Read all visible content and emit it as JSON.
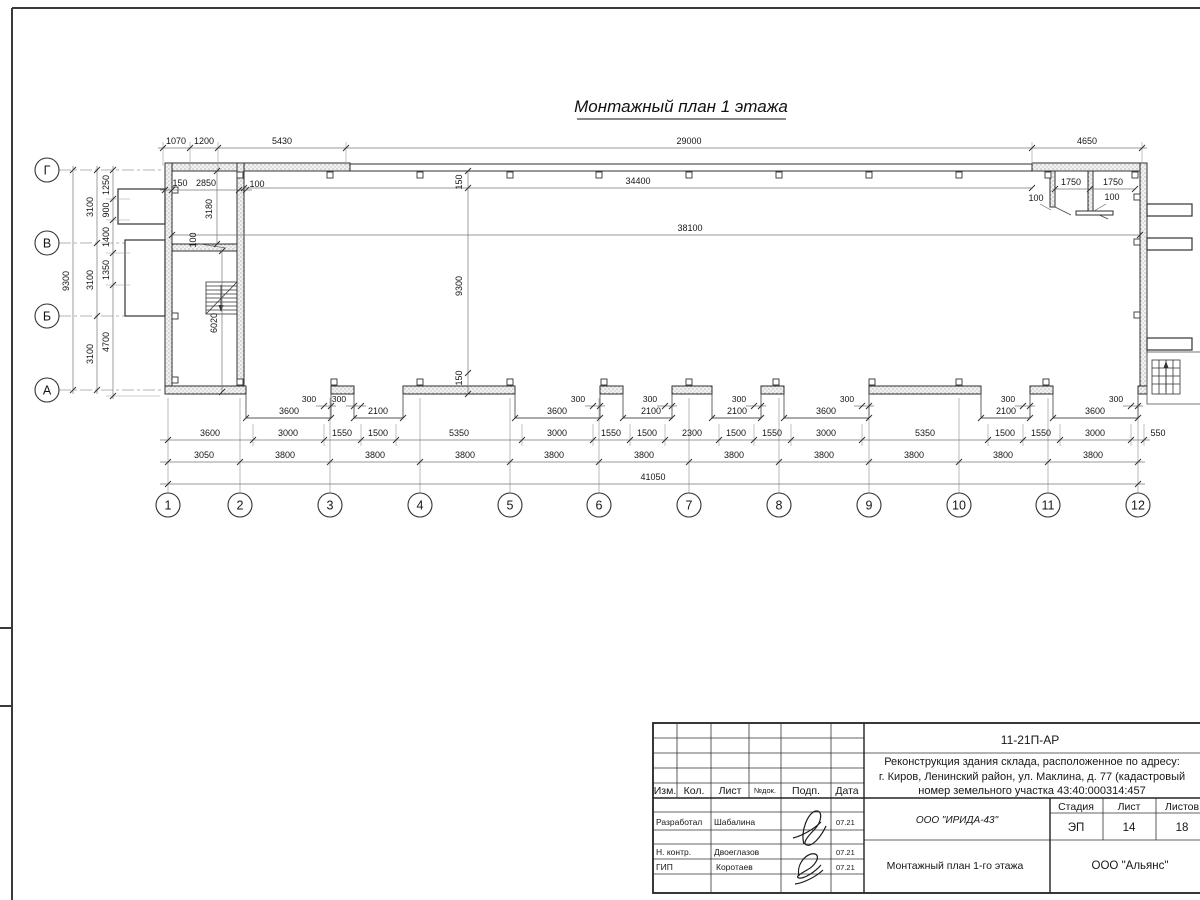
{
  "sheet": {
    "title": "Монтажный план 1 этажа"
  },
  "axes": {
    "columns": [
      "1",
      "2",
      "3",
      "4",
      "5",
      "6",
      "7",
      "8",
      "9",
      "10",
      "11",
      "12"
    ],
    "rows": [
      "Г",
      "В",
      "Б",
      "А"
    ]
  },
  "dims": {
    "top": [
      "1070",
      "1200",
      "5430",
      "29000",
      "4650"
    ],
    "tl_room": {
      "d150": "150",
      "d2850": "2850",
      "d100a": "100",
      "d3180": "3180",
      "d100b": "100",
      "d6020": "6020"
    },
    "hall": {
      "d34400": "34400",
      "d38100": "38100",
      "d9300": "9300",
      "d150t": "150",
      "d150b": "150"
    },
    "tr_rooms": {
      "d1750a": "1750",
      "d1750b": "1750",
      "d100a": "100",
      "d100b": "100"
    },
    "left": {
      "total": "9300",
      "c3100": [
        "3100",
        "3100",
        "3100"
      ],
      "inner": [
        "1250",
        "900",
        "1400",
        "1350",
        "4700"
      ]
    },
    "gates": {
      "widths": [
        "3600",
        "2100",
        "3600",
        "2100",
        "2100",
        "3600",
        "2100",
        "3600"
      ],
      "offset": "300"
    },
    "chain1": [
      "3600",
      "3000",
      "1550",
      "1500",
      "5350",
      "3000",
      "1550",
      "1500",
      "2300",
      "1500",
      "1550",
      "3000",
      "5350",
      "1500",
      "1550",
      "3000",
      "550"
    ],
    "chain2": [
      "3050",
      "3800",
      "3800",
      "3800",
      "3800",
      "3800",
      "3800",
      "3800",
      "3800",
      "3800",
      "3800"
    ],
    "total": "41050"
  },
  "titleblock": {
    "doc": "11-21П-АР",
    "project": [
      "Реконструкция здания склада, расположенное по адресу:",
      "г. Киров, Ленинский район, ул. Маклина, д. 77 (кадастровый",
      "номер земельного участка 43:40:000314:457"
    ],
    "cols": [
      "Изм.",
      "Кол.",
      "Лист",
      "№док.",
      "Подп.",
      "Дата"
    ],
    "roles": [
      {
        "role": "Разработал",
        "name": "Шабалина",
        "date": "07.21"
      },
      {
        "role": "Н. контр.",
        "name": "Двоеглазов",
        "date": "07.21"
      },
      {
        "role": "ГИП",
        "name": "Коротаев",
        "date": "07.21"
      }
    ],
    "org": "ООО \"ИРИДА-43\"",
    "stage_h": "Стадия",
    "sheet_h": "Лист",
    "sheets_h": "Листов",
    "stage": "ЭП",
    "sheet_no": "14",
    "sheets_total": "18",
    "drawing": "Монтажный план 1-го этажа",
    "contractor": "ООО \"Альянс\""
  }
}
